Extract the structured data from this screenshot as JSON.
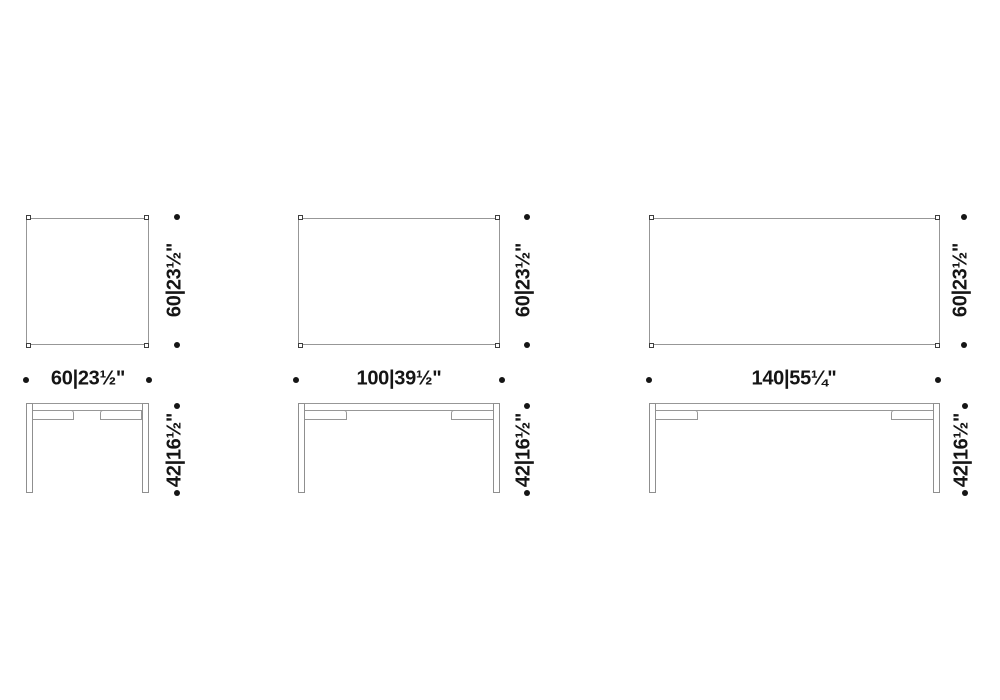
{
  "diagram": {
    "description": "dimension drawing of three rectangular tables, plan and front elevation",
    "colors": {
      "background": "#ffffff",
      "outline": "#979797",
      "leg_cap_outline": "#3f3f3f",
      "ink": "#151515"
    },
    "tables": [
      {
        "id": "table-60",
        "width_label": "60|23½\"",
        "depth_label": "60|23½\"",
        "height_label": "42|16½\""
      },
      {
        "id": "table-100",
        "width_label": "100|39½\"",
        "depth_label": "60|23½\"",
        "height_label": "42|16½\""
      },
      {
        "id": "table-140",
        "width_label": "140|55¼\"",
        "depth_label": "60|23½\"",
        "height_label": "42|16½\""
      }
    ]
  }
}
